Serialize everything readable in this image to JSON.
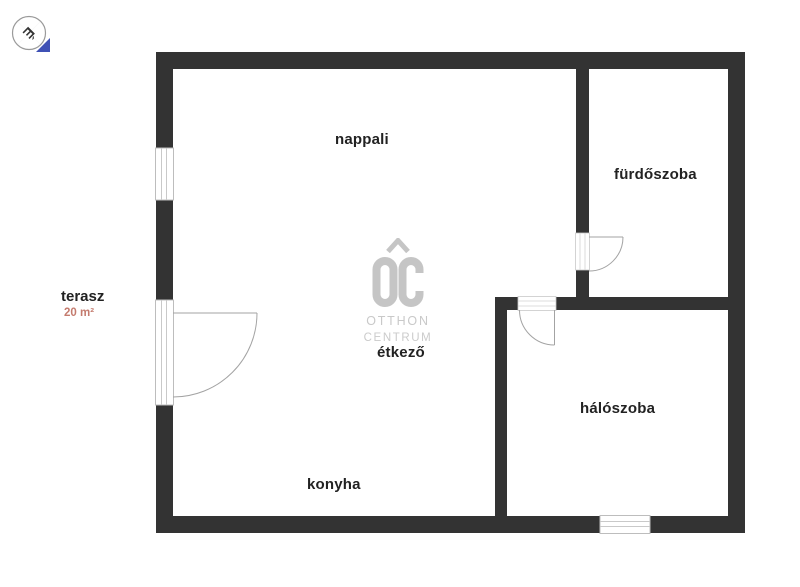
{
  "compass": {
    "north_letter": "É"
  },
  "brand": {
    "initials": "OC",
    "name_line1": "OTTHON",
    "name_line2": "CENTRUM"
  },
  "rooms": {
    "living": "nappali",
    "bathroom": "fürdőszoba",
    "dining": "étkező",
    "bedroom": "hálószoba",
    "kitchen": "konyha"
  },
  "terrace": {
    "label": "terasz",
    "area": "20 m²"
  },
  "colors": {
    "wall": "#333333",
    "area_accent": "#c47b6e",
    "watermark_gray": "#c5c5c5",
    "compass_blue": "#3f51b5",
    "opening_gray": "#bdbdbd"
  }
}
